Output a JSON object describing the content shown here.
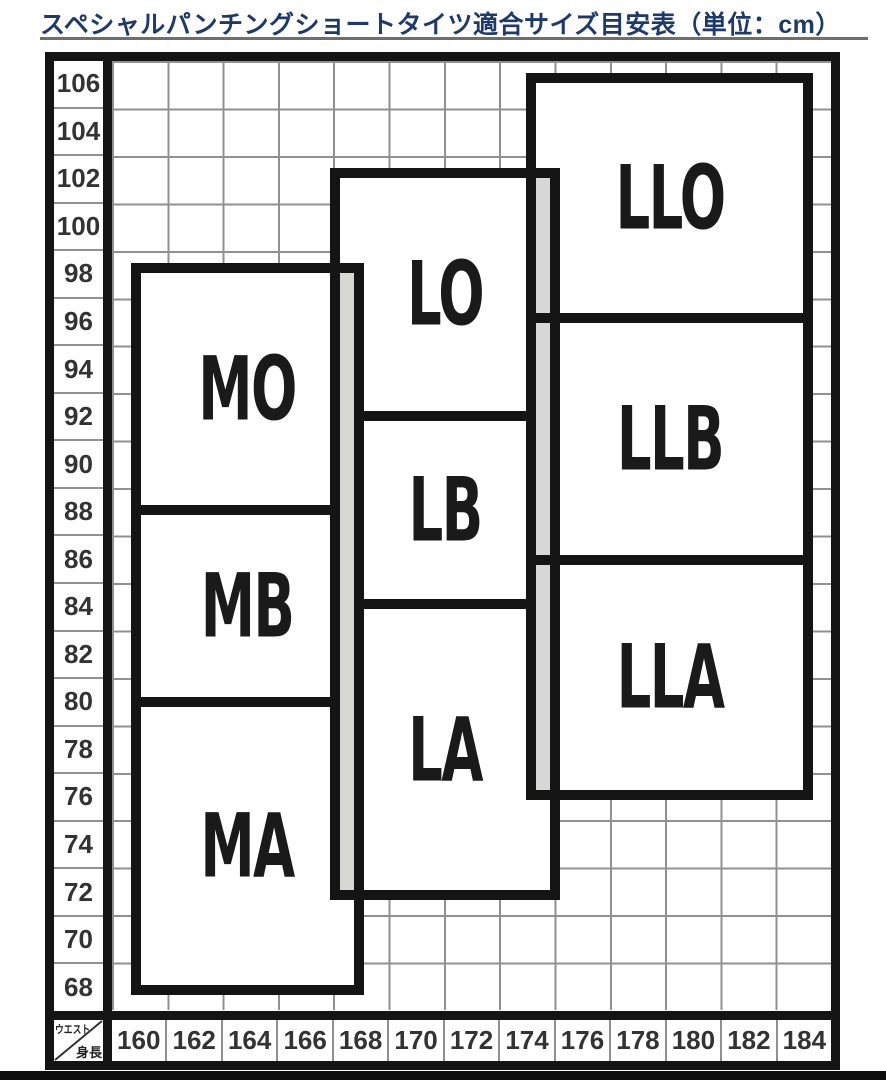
{
  "title": {
    "text": "スペシャルパンチングショートタイツ適合サイズ目安表（単位：cm）"
  },
  "axes": {
    "y_label": "ウエスト",
    "x_label": "身長"
  },
  "sizes": {
    "mo": "MO",
    "mb": "MB",
    "ma": "MA",
    "lo": "LO",
    "lb": "LB",
    "la": "LA",
    "llo": "LLO",
    "llb": "LLB",
    "lla": "LLA"
  },
  "chart_data": {
    "type": "table",
    "title": "スペシャルパンチングショートタイツ適合サイズ目安表",
    "unit": "cm",
    "x_axis": {
      "label": "身長",
      "ticks": [
        160,
        162,
        164,
        166,
        168,
        170,
        172,
        174,
        176,
        178,
        180,
        182,
        184
      ]
    },
    "y_axis": {
      "label": "ウエスト",
      "ticks": [
        106,
        104,
        102,
        100,
        98,
        96,
        94,
        92,
        90,
        88,
        86,
        84,
        82,
        80,
        78,
        76,
        74,
        72,
        70,
        68
      ]
    },
    "grid": true,
    "regions": [
      {
        "size": "MA",
        "height_range": [
          160,
          168
        ],
        "waist_range": [
          68,
          80
        ]
      },
      {
        "size": "MB",
        "height_range": [
          160,
          168
        ],
        "waist_range": [
          80,
          88
        ]
      },
      {
        "size": "MO",
        "height_range": [
          160,
          168
        ],
        "waist_range": [
          88,
          98
        ]
      },
      {
        "size": "LA",
        "height_range": [
          167,
          175
        ],
        "waist_range": [
          72,
          84
        ]
      },
      {
        "size": "LB",
        "height_range": [
          167,
          175
        ],
        "waist_range": [
          84,
          92
        ]
      },
      {
        "size": "LO",
        "height_range": [
          167,
          175
        ],
        "waist_range": [
          92,
          102
        ]
      },
      {
        "size": "LLA",
        "height_range": [
          174,
          184
        ],
        "waist_range": [
          76,
          86
        ]
      },
      {
        "size": "LLB",
        "height_range": [
          174,
          184
        ],
        "waist_range": [
          86,
          96
        ]
      },
      {
        "size": "LLO",
        "height_range": [
          174,
          184
        ],
        "waist_range": [
          96,
          106
        ]
      }
    ]
  }
}
